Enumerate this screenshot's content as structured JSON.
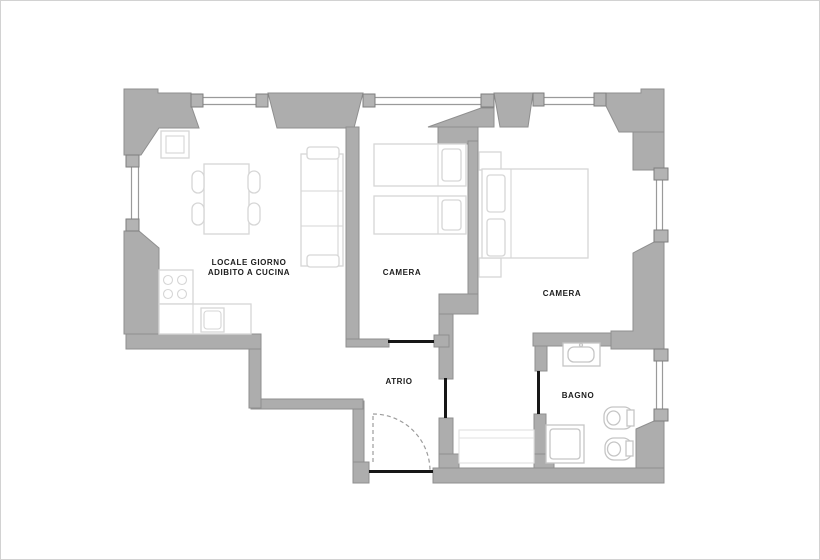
{
  "plan": {
    "title": "apartment-floor-plan",
    "canvas": {
      "width": 820,
      "height": 560,
      "background": "#ffffff",
      "frame_color": "#d2d2d2"
    },
    "palette": {
      "wall": "#adadad",
      "wall_outline": "#8f8f8f",
      "window_jamb": "#b3b3b3",
      "furniture_line": "#d6d6d6",
      "fixture_line": "#c5c5c5",
      "door_line": "#171717",
      "swing_line": "#9c9c9c",
      "label_text": "#1c1c1c"
    },
    "rooms": [
      {
        "id": "living-kitchen",
        "lines": [
          "LOCALE GIORNO",
          "ADIBITO A CUCINA"
        ],
        "x": 248,
        "y": 264
      },
      {
        "id": "camera-1",
        "lines": [
          "CAMERA"
        ],
        "x": 401,
        "y": 274
      },
      {
        "id": "camera-2",
        "lines": [
          "CAMERA"
        ],
        "x": 561,
        "y": 295
      },
      {
        "id": "atrio",
        "lines": [
          "ATRIO"
        ],
        "x": 398,
        "y": 383
      },
      {
        "id": "bagno",
        "lines": [
          "BAGNO"
        ],
        "x": 577,
        "y": 397
      }
    ],
    "shapes": [
      {
        "t": "poly",
        "c": "wall",
        "n": "outer-wall-top-left",
        "pts": "123,88 157,88 157,92 190,92 190,104 198,127 158,127 140,154 123,154"
      },
      {
        "t": "poly",
        "c": "wall",
        "n": "outer-wall-top-a",
        "pts": "267,92 362,92 353,127 276,127"
      },
      {
        "t": "poly",
        "c": "wall",
        "n": "outer-wall-top-b",
        "pts": "493,92 532,92 527,126 499,126"
      },
      {
        "t": "poly",
        "c": "wall",
        "n": "outer-wall-top-reveal",
        "pts": "427,126 480,107 493,107 493,126"
      },
      {
        "t": "rect",
        "c": "wall",
        "n": "outer-wall-top-stub",
        "x": 437,
        "y": 126,
        "w": 40,
        "h": 17
      },
      {
        "t": "poly",
        "c": "wall",
        "n": "outer-wall-top-right-corner",
        "pts": "605,92 640,92 640,88 663,88 663,131 618,131 605,105"
      },
      {
        "t": "rect",
        "c": "wall",
        "n": "outer-wall-right-upper",
        "x": 632,
        "y": 131,
        "w": 31,
        "h": 38
      },
      {
        "t": "poly",
        "c": "wall",
        "n": "outer-wall-right-mid",
        "pts": "653,241 663,241 663,348 610,348 610,330 632,330 632,252"
      },
      {
        "t": "rect",
        "c": "wall",
        "n": "bagno-top-wall",
        "x": 532,
        "y": 332,
        "w": 78,
        "h": 13
      },
      {
        "t": "poly",
        "c": "wall",
        "n": "outer-wall-bottom-right-corner",
        "pts": "653,420 663,420 663,482 635,482 635,428"
      },
      {
        "t": "rect",
        "c": "wall",
        "n": "outer-wall-bottom",
        "x": 432,
        "y": 467,
        "w": 231,
        "h": 15
      },
      {
        "t": "rect",
        "c": "wall",
        "n": "entry-wall-left",
        "x": 352,
        "y": 400,
        "w": 11,
        "h": 82
      },
      {
        "t": "rect",
        "c": "wall",
        "n": "entry-wall-foot",
        "x": 352,
        "y": 461,
        "w": 16,
        "h": 21
      },
      {
        "t": "rect",
        "c": "wall",
        "n": "atrio-bottom-step-wall",
        "x": 250,
        "y": 398,
        "w": 112,
        "h": 10
      },
      {
        "t": "rect",
        "c": "wall",
        "n": "atrio-left-step-wall",
        "x": 248,
        "y": 343,
        "w": 12,
        "h": 64
      },
      {
        "t": "rect",
        "c": "wall",
        "n": "kitchen-bottom-wall",
        "x": 125,
        "y": 333,
        "w": 135,
        "h": 15
      },
      {
        "t": "poly",
        "c": "wall",
        "n": "outer-wall-left-lower",
        "pts": "123,230 138,230 158,247 158,333 123,333"
      },
      {
        "t": "rect",
        "c": "wall",
        "n": "camera1-left-wall",
        "x": 345,
        "y": 126,
        "w": 13,
        "h": 212
      },
      {
        "t": "rect",
        "c": "wall",
        "n": "camera1-left-wall-foot",
        "x": 345,
        "y": 338,
        "w": 43,
        "h": 8
      },
      {
        "t": "rect",
        "c": "wall",
        "n": "camera-divider-wall",
        "x": 467,
        "y": 140,
        "w": 10,
        "h": 153
      },
      {
        "t": "rect",
        "c": "wall",
        "n": "camera-divider-step",
        "x": 438,
        "y": 293,
        "w": 39,
        "h": 20
      },
      {
        "t": "rect",
        "c": "wall",
        "n": "alcove-wall-upper",
        "x": 438,
        "y": 313,
        "w": 14,
        "h": 65
      },
      {
        "t": "rect",
        "c": "wall",
        "n": "camera1-door-block",
        "x": 433,
        "y": 334,
        "w": 15,
        "h": 12
      },
      {
        "t": "rect",
        "c": "wall",
        "n": "alcove-wall-lower",
        "x": 438,
        "y": 417,
        "w": 14,
        "h": 50
      },
      {
        "t": "rect",
        "c": "wall",
        "n": "alcove-wall-foot",
        "x": 438,
        "y": 453,
        "w": 20,
        "h": 14
      },
      {
        "t": "rect",
        "c": "wall",
        "n": "bagno-left-wall-upper",
        "x": 534,
        "y": 345,
        "w": 12,
        "h": 25
      },
      {
        "t": "rect",
        "c": "wall",
        "n": "bagno-left-wall-lower",
        "x": 533,
        "y": 413,
        "w": 12,
        "h": 54
      },
      {
        "t": "rect",
        "c": "wall",
        "n": "bagno-left-wall-foot",
        "x": 533,
        "y": 453,
        "w": 20,
        "h": 14
      },
      {
        "t": "line",
        "c": "glass",
        "n": "window-glass",
        "x1": 202,
        "y1": 96.5,
        "x2": 255,
        "y2": 96.5
      },
      {
        "t": "line",
        "c": "glass",
        "n": "window-glass",
        "x1": 202,
        "y1": 103.5,
        "x2": 255,
        "y2": 103.5
      },
      {
        "t": "line",
        "c": "glass",
        "n": "window-glass",
        "x1": 374,
        "y1": 96.5,
        "x2": 480,
        "y2": 96.5
      },
      {
        "t": "line",
        "c": "glass",
        "n": "window-glass",
        "x1": 374,
        "y1": 103.5,
        "x2": 480,
        "y2": 103.5
      },
      {
        "t": "line",
        "c": "glass",
        "n": "window-glass",
        "x1": 543,
        "y1": 96.5,
        "x2": 593,
        "y2": 96.5
      },
      {
        "t": "line",
        "c": "glass",
        "n": "window-glass",
        "x1": 543,
        "y1": 103.5,
        "x2": 593,
        "y2": 103.5
      },
      {
        "t": "line",
        "c": "glass",
        "n": "window-glass",
        "x1": 130.5,
        "y1": 166,
        "x2": 130.5,
        "y2": 218
      },
      {
        "t": "line",
        "c": "glass",
        "n": "window-glass",
        "x1": 137.5,
        "y1": 166,
        "x2": 137.5,
        "y2": 218
      },
      {
        "t": "line",
        "c": "glass",
        "n": "window-glass",
        "x1": 655.5,
        "y1": 179,
        "x2": 655.5,
        "y2": 229
      },
      {
        "t": "line",
        "c": "glass",
        "n": "window-glass",
        "x1": 661.5,
        "y1": 179,
        "x2": 661.5,
        "y2": 229
      },
      {
        "t": "line",
        "c": "glass",
        "n": "window-glass",
        "x1": 655.5,
        "y1": 360,
        "x2": 655.5,
        "y2": 408
      },
      {
        "t": "line",
        "c": "glass",
        "n": "window-glass",
        "x1": 661.5,
        "y1": 360,
        "x2": 661.5,
        "y2": 408
      },
      {
        "t": "rect",
        "c": "jamb",
        "n": "window-jamb",
        "x": 190,
        "y": 93,
        "w": 12,
        "h": 13
      },
      {
        "t": "rect",
        "c": "jamb",
        "n": "window-jamb",
        "x": 255,
        "y": 93,
        "w": 12,
        "h": 13
      },
      {
        "t": "rect",
        "c": "jamb",
        "n": "window-jamb",
        "x": 362,
        "y": 93,
        "w": 12,
        "h": 13
      },
      {
        "t": "rect",
        "c": "jamb",
        "n": "window-jamb",
        "x": 480,
        "y": 93,
        "w": 13,
        "h": 13
      },
      {
        "t": "rect",
        "c": "jamb",
        "n": "window-jamb",
        "x": 532,
        "y": 92,
        "w": 11,
        "h": 13
      },
      {
        "t": "rect",
        "c": "jamb",
        "n": "window-jamb",
        "x": 593,
        "y": 92,
        "w": 12,
        "h": 13
      },
      {
        "t": "rect",
        "c": "jamb",
        "n": "window-jamb",
        "x": 653,
        "y": 167,
        "w": 14,
        "h": 12
      },
      {
        "t": "rect",
        "c": "jamb",
        "n": "window-jamb",
        "x": 653,
        "y": 229,
        "w": 14,
        "h": 12
      },
      {
        "t": "rect",
        "c": "jamb",
        "n": "window-jamb",
        "x": 653,
        "y": 348,
        "w": 14,
        "h": 12
      },
      {
        "t": "rect",
        "c": "jamb",
        "n": "window-jamb",
        "x": 653,
        "y": 408,
        "w": 14,
        "h": 12
      },
      {
        "t": "rect",
        "c": "jamb",
        "n": "window-jamb",
        "x": 125,
        "y": 154,
        "w": 13,
        "h": 12
      },
      {
        "t": "rect",
        "c": "jamb",
        "n": "window-jamb",
        "x": 125,
        "y": 218,
        "w": 13,
        "h": 12
      },
      {
        "t": "rect",
        "c": "furn",
        "n": "kitchen-corner-cabinet",
        "x": 160,
        "y": 130,
        "w": 28,
        "h": 27
      },
      {
        "t": "rect",
        "c": "furnline",
        "n": "kitchen-corner-cabinet-inner",
        "x": 165,
        "y": 135,
        "w": 18,
        "h": 17
      },
      {
        "t": "rect",
        "c": "furn",
        "n": "dining-table",
        "x": 203,
        "y": 163,
        "w": 45,
        "h": 70
      },
      {
        "t": "rect",
        "c": "furn",
        "n": "chair",
        "x": 191,
        "y": 170,
        "w": 12,
        "h": 22,
        "rx": 6
      },
      {
        "t": "rect",
        "c": "furn",
        "n": "chair",
        "x": 191,
        "y": 202,
        "w": 12,
        "h": 22,
        "rx": 6
      },
      {
        "t": "rect",
        "c": "furn",
        "n": "chair",
        "x": 247,
        "y": 170,
        "w": 12,
        "h": 22,
        "rx": 6
      },
      {
        "t": "rect",
        "c": "furn",
        "n": "chair",
        "x": 247,
        "y": 202,
        "w": 12,
        "h": 22,
        "rx": 6
      },
      {
        "t": "rect",
        "c": "furn",
        "n": "sofa",
        "x": 300,
        "y": 153,
        "w": 42,
        "h": 112
      },
      {
        "t": "line",
        "c": "furnline",
        "n": "sofa-cushion-line",
        "x1": 300,
        "y1": 190,
        "x2": 342,
        "y2": 190
      },
      {
        "t": "line",
        "c": "furnline",
        "n": "sofa-cushion-line",
        "x1": 300,
        "y1": 225,
        "x2": 342,
        "y2": 225
      },
      {
        "t": "line",
        "c": "furnline",
        "n": "sofa-back-line",
        "x1": 337,
        "y1": 158,
        "x2": 337,
        "y2": 260
      },
      {
        "t": "rect",
        "c": "furn",
        "n": "sofa-armrest",
        "x": 306,
        "y": 146,
        "w": 32,
        "h": 12,
        "rx": 3
      },
      {
        "t": "rect",
        "c": "furn",
        "n": "sofa-armrest",
        "x": 306,
        "y": 254,
        "w": 32,
        "h": 12,
        "rx": 3
      },
      {
        "t": "rect",
        "c": "furn",
        "n": "stove",
        "x": 158,
        "y": 269,
        "w": 34,
        "h": 34
      },
      {
        "t": "circle",
        "c": "furnline",
        "n": "burner",
        "cx": 167,
        "cy": 279,
        "r": 4.5
      },
      {
        "t": "circle",
        "c": "furnline",
        "n": "burner",
        "cx": 181,
        "cy": 279,
        "r": 4.5
      },
      {
        "t": "circle",
        "c": "furnline",
        "n": "burner",
        "cx": 167,
        "cy": 293,
        "r": 4.5
      },
      {
        "t": "circle",
        "c": "furnline",
        "n": "burner",
        "cx": 181,
        "cy": 293,
        "r": 4.5
      },
      {
        "t": "rect",
        "c": "furn",
        "n": "kitchen-counter",
        "x": 158,
        "y": 303,
        "w": 92,
        "h": 30
      },
      {
        "t": "line",
        "c": "furnline",
        "n": "kitchen-counter-line",
        "x1": 192,
        "y1": 303,
        "x2": 192,
        "y2": 333
      },
      {
        "t": "rect",
        "c": "furn",
        "n": "kitchen-sink",
        "x": 200,
        "y": 307,
        "w": 23,
        "h": 24
      },
      {
        "t": "rect",
        "c": "furnline",
        "n": "kitchen-sink-basin",
        "x": 203,
        "y": 310,
        "w": 17,
        "h": 18,
        "rx": 3
      },
      {
        "t": "rect",
        "c": "furn",
        "n": "single-bed",
        "x": 373,
        "y": 143,
        "w": 92,
        "h": 42
      },
      {
        "t": "line",
        "c": "furnline",
        "n": "bed-line",
        "x1": 437,
        "y1": 143,
        "x2": 437,
        "y2": 185
      },
      {
        "t": "rect",
        "c": "furn",
        "n": "pillow",
        "x": 441,
        "y": 148,
        "w": 19,
        "h": 32,
        "rx": 3
      },
      {
        "t": "rect",
        "c": "furn",
        "n": "single-bed",
        "x": 373,
        "y": 195,
        "w": 92,
        "h": 38
      },
      {
        "t": "line",
        "c": "furnline",
        "n": "bed-line",
        "x1": 437,
        "y1": 195,
        "x2": 437,
        "y2": 233
      },
      {
        "t": "rect",
        "c": "furn",
        "n": "pillow",
        "x": 441,
        "y": 199,
        "w": 19,
        "h": 30,
        "rx": 3
      },
      {
        "t": "rect",
        "c": "furn",
        "n": "nightstand",
        "x": 478,
        "y": 151,
        "w": 22,
        "h": 18
      },
      {
        "t": "rect",
        "c": "furn",
        "n": "nightstand",
        "x": 478,
        "y": 257,
        "w": 22,
        "h": 19
      },
      {
        "t": "rect",
        "c": "furn",
        "n": "double-bed",
        "x": 481,
        "y": 168,
        "w": 106,
        "h": 89
      },
      {
        "t": "line",
        "c": "furnline",
        "n": "bed-line",
        "x1": 510,
        "y1": 168,
        "x2": 510,
        "y2": 257
      },
      {
        "t": "rect",
        "c": "furn",
        "n": "pillow",
        "x": 486,
        "y": 174,
        "w": 18,
        "h": 37,
        "rx": 3
      },
      {
        "t": "rect",
        "c": "furn",
        "n": "pillow",
        "x": 486,
        "y": 218,
        "w": 18,
        "h": 37,
        "rx": 3
      },
      {
        "t": "rect",
        "c": "furn-light",
        "n": "wardrobe",
        "x": 458,
        "y": 429,
        "w": 75,
        "h": 33
      },
      {
        "t": "line",
        "c": "furn-light",
        "n": "wardrobe-line",
        "x1": 458,
        "y1": 437,
        "x2": 533,
        "y2": 437
      },
      {
        "t": "rect",
        "c": "fixt",
        "n": "bathroom-sink",
        "x": 562,
        "y": 342,
        "w": 37,
        "h": 23
      },
      {
        "t": "rect",
        "c": "fixt",
        "n": "bathroom-sink-basin",
        "x": 567,
        "y": 346,
        "w": 26,
        "h": 15,
        "rx": 6
      },
      {
        "t": "circle",
        "c": "fixt",
        "n": "sink-tap",
        "cx": 580,
        "cy": 344,
        "r": 1.5
      },
      {
        "t": "rect",
        "c": "fixt",
        "n": "shower-tray",
        "x": 545,
        "y": 424,
        "w": 38,
        "h": 38
      },
      {
        "t": "rect",
        "c": "fixt",
        "n": "shower-tray-inner",
        "x": 549,
        "y": 428,
        "w": 30,
        "h": 30,
        "rx": 3
      },
      {
        "t": "rect",
        "c": "fixt",
        "n": "toilet",
        "x": 603,
        "y": 406,
        "w": 29,
        "h": 22,
        "rx": 9
      },
      {
        "t": "ellipse",
        "c": "fixt",
        "n": "toilet-bowl",
        "cx": 612.5,
        "cy": 417,
        "rx": 6.5,
        "ry": 7
      },
      {
        "t": "rect",
        "c": "fixt",
        "n": "toilet-cistern",
        "x": 626,
        "y": 409,
        "w": 7,
        "h": 16
      },
      {
        "t": "rect",
        "c": "fixt",
        "n": "bidet",
        "x": 604,
        "y": 437,
        "w": 27,
        "h": 22,
        "rx": 9
      },
      {
        "t": "ellipse",
        "c": "fixt",
        "n": "bidet-bowl",
        "cx": 613,
        "cy": 448,
        "rx": 6.5,
        "ry": 7
      },
      {
        "t": "rect",
        "c": "fixt",
        "n": "bidet-tap",
        "x": 625,
        "y": 440,
        "w": 7,
        "h": 15
      },
      {
        "t": "rect",
        "c": "door",
        "n": "camera1-door-opening",
        "x": 387,
        "y": 339,
        "w": 46,
        "h": 3
      },
      {
        "t": "rect",
        "c": "door",
        "n": "alcove-door-opening",
        "x": 443,
        "y": 377,
        "w": 3,
        "h": 40
      },
      {
        "t": "rect",
        "c": "door",
        "n": "bagno-door-opening",
        "x": 536,
        "y": 370,
        "w": 3,
        "h": 43
      },
      {
        "t": "rect",
        "c": "door",
        "n": "entry-door-leaf",
        "x": 368,
        "y": 469,
        "w": 64,
        "h": 3
      },
      {
        "t": "path",
        "c": "swing",
        "n": "entry-door-swing",
        "d": "M 372 413 A 57 57 0 0 1 429 470"
      },
      {
        "t": "line",
        "c": "swing",
        "n": "entry-door-swing-edge",
        "x1": 372,
        "y1": 415,
        "x2": 372,
        "y2": 464
      }
    ]
  }
}
